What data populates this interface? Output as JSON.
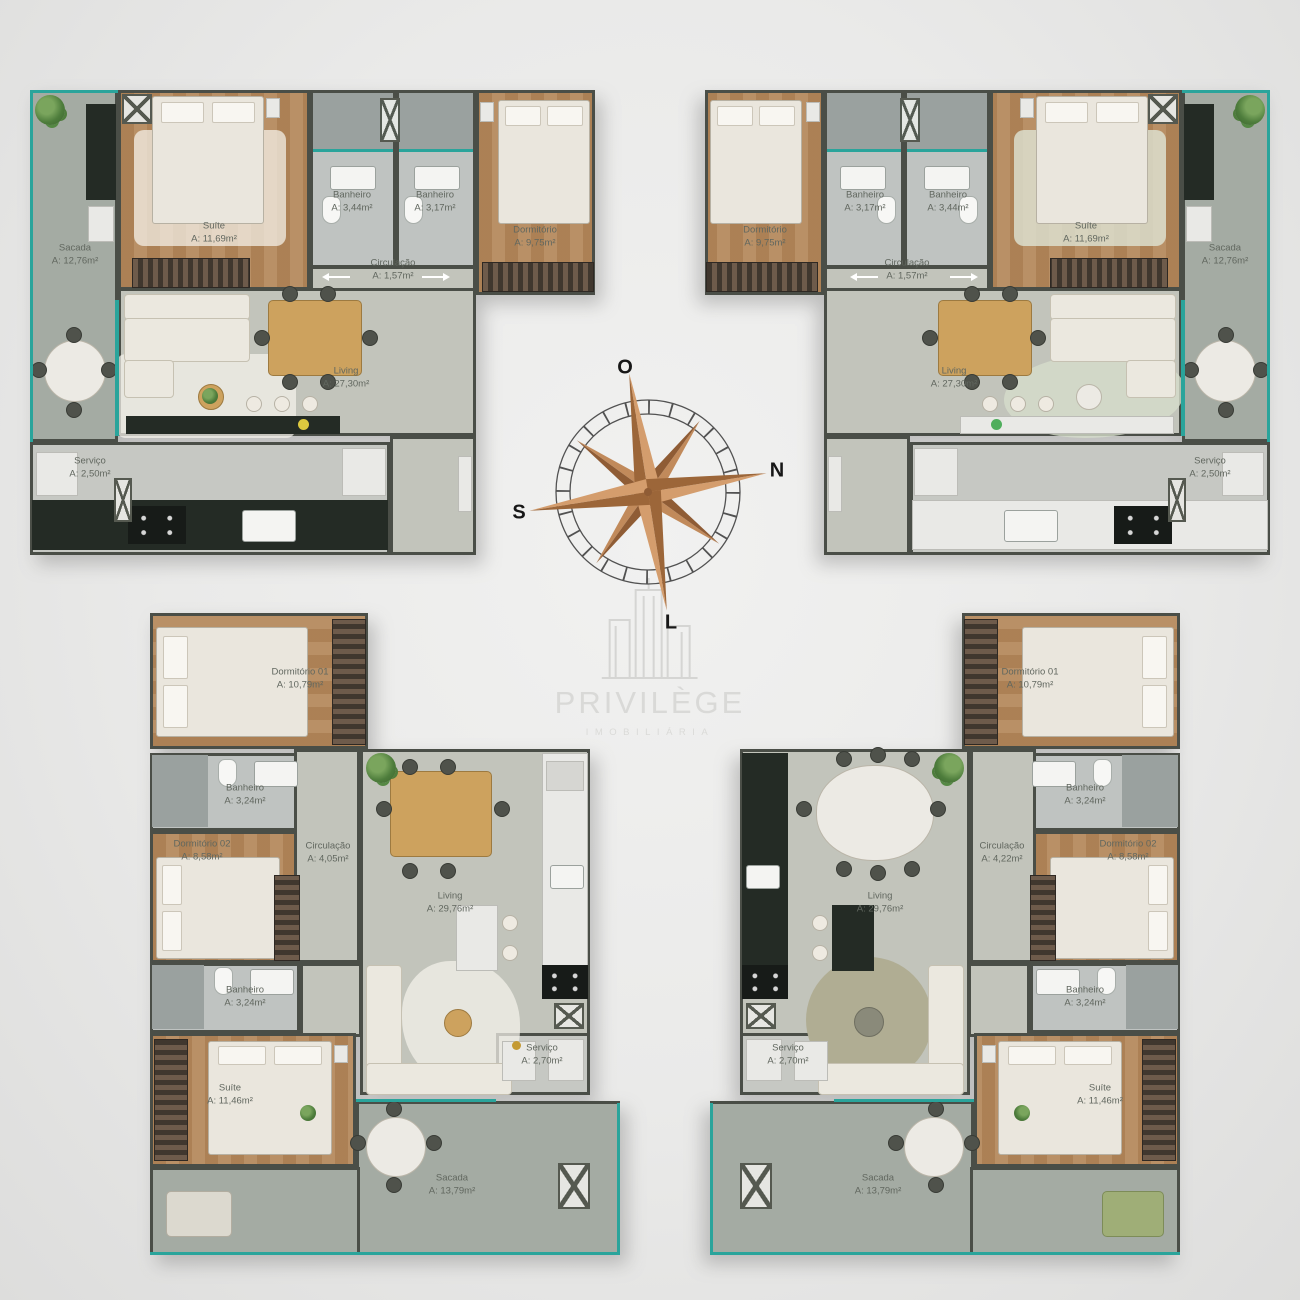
{
  "watermark": {
    "title": "PRIVILÈGE",
    "subtitle": "IMOBILIÁRIA"
  },
  "compass": {
    "o": "O",
    "n": "N",
    "s": "S",
    "l": "L"
  },
  "palette": {
    "glass_teal": "#2aa49b",
    "compass_wood_light": "#d49d6d",
    "compass_wood_dark": "#9c6639",
    "wood_floor": "#b5895c",
    "balcony_floor": "#a4aba3"
  },
  "units": [
    {
      "id": "top-left",
      "rooms": [
        {
          "name": "Sacada",
          "area": "A: 12,76m²"
        },
        {
          "name": "Suíte",
          "area": "A: 11,69m²"
        },
        {
          "name": "Banheiro",
          "area": "A: 3,44m²"
        },
        {
          "name": "Banheiro",
          "area": "A: 3,17m²"
        },
        {
          "name": "Dormitório",
          "area": "A: 9,75m²"
        },
        {
          "name": "Circulação",
          "area": "A: 1,57m²"
        },
        {
          "name": "Living",
          "area": "A: 27,30m²"
        },
        {
          "name": "Serviço",
          "area": "A: 2,50m²"
        }
      ]
    },
    {
      "id": "top-right",
      "rooms": [
        {
          "name": "Sacada",
          "area": "A: 12,76m²"
        },
        {
          "name": "Suíte",
          "area": "A: 11,69m²"
        },
        {
          "name": "Banheiro",
          "area": "A: 3,44m²"
        },
        {
          "name": "Banheiro",
          "area": "A: 3,17m²"
        },
        {
          "name": "Dormitório",
          "area": "A: 9,75m²"
        },
        {
          "name": "Circulação",
          "area": "A: 1,57m²"
        },
        {
          "name": "Living",
          "area": "A: 27,30m²"
        },
        {
          "name": "Serviço",
          "area": "A: 2,50m²"
        }
      ]
    },
    {
      "id": "bottom-left",
      "rooms": [
        {
          "name": "Dormitório 01",
          "area": "A: 10,79m²"
        },
        {
          "name": "Banheiro",
          "area": "A: 3,24m²"
        },
        {
          "name": "Dormitório 02",
          "area": "A: 8,58m²"
        },
        {
          "name": "Circulação",
          "area": "A: 4,05m²"
        },
        {
          "name": "Living",
          "area": "A: 29,76m²"
        },
        {
          "name": "Banheiro",
          "area": "A: 3,24m²"
        },
        {
          "name": "Suíte",
          "area": "A: 11,46m²"
        },
        {
          "name": "Serviço",
          "area": "A: 2,70m²"
        },
        {
          "name": "Sacada",
          "area": "A: 13,79m²"
        }
      ]
    },
    {
      "id": "bottom-right",
      "rooms": [
        {
          "name": "Dormitório 01",
          "area": "A: 10,79m²"
        },
        {
          "name": "Banheiro",
          "area": "A: 3,24m²"
        },
        {
          "name": "Dormitório 02",
          "area": "A: 8,58m²"
        },
        {
          "name": "Circulação",
          "area": "A: 4,22m²"
        },
        {
          "name": "Living",
          "area": "A: 29,76m²"
        },
        {
          "name": "Banheiro",
          "area": "A: 3,24m²"
        },
        {
          "name": "Suíte",
          "area": "A: 11,46m²"
        },
        {
          "name": "Serviço",
          "area": "A: 2,70m²"
        },
        {
          "name": "Sacada",
          "area": "A: 13,79m²"
        }
      ]
    }
  ]
}
